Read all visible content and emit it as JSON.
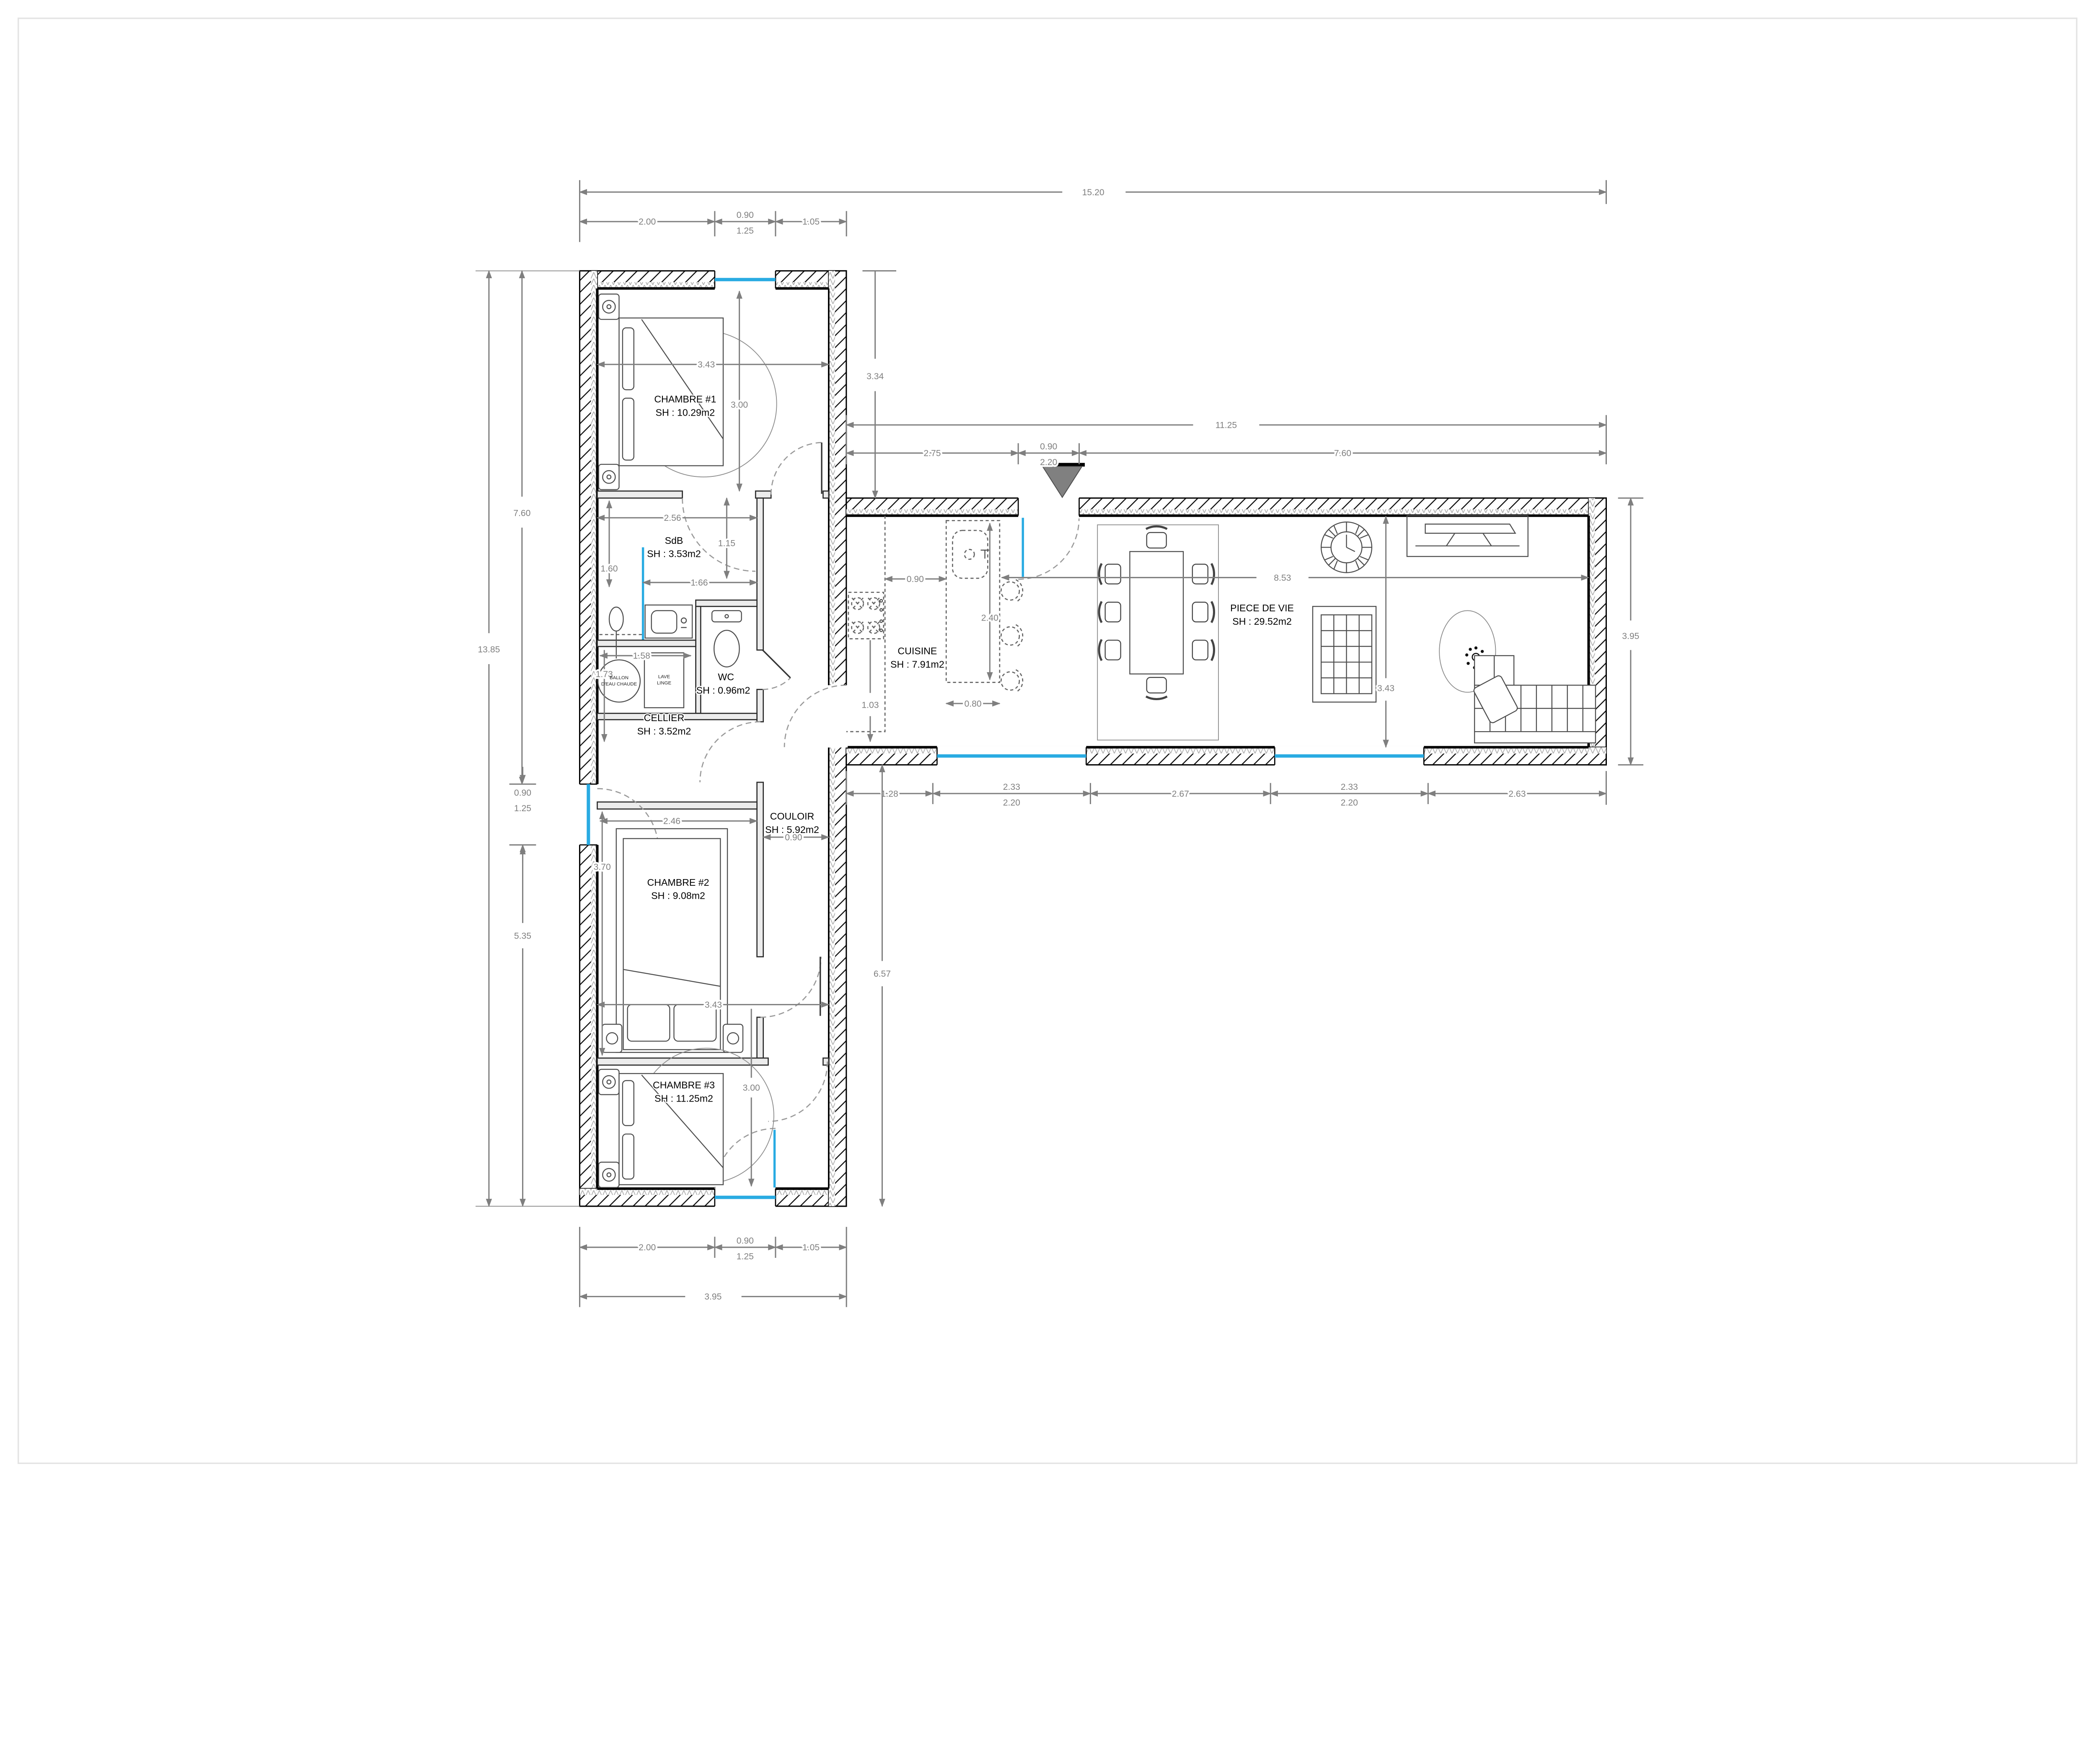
{
  "page": {
    "background": "#ffffff",
    "border_color": "#e3e3e3"
  },
  "colors": {
    "window": "#29abe2",
    "dimension": "#7f7f7f",
    "wall": "#000000",
    "partition_fill": "#ececec",
    "entrance_marker": "#808080"
  },
  "rooms": [
    {
      "id": "chambre1",
      "name": "CHAMBRE #1",
      "area": "SH : 10.29m2"
    },
    {
      "id": "sdb",
      "name": "SdB",
      "area": "SH : 3.53m2"
    },
    {
      "id": "wc",
      "name": "WC",
      "area": "SH : 0.96m2"
    },
    {
      "id": "cellier",
      "name": "CELLIER",
      "area": "SH : 3.52m2"
    },
    {
      "id": "couloir",
      "name": "COULOIR",
      "area": "SH : 5.92m2"
    },
    {
      "id": "chambre2",
      "name": "CHAMBRE #2",
      "area": "SH : 9.08m2"
    },
    {
      "id": "chambre3",
      "name": "CHAMBRE #3",
      "area": "SH : 11.25m2"
    },
    {
      "id": "cuisine",
      "name": "CUISINE",
      "area": "SH : 7.91m2"
    },
    {
      "id": "piece_de_vie",
      "name": "PIECE DE VIE",
      "area": "SH : 29.52m2"
    }
  ],
  "fixtures": {
    "ballon_l1": "BALLON",
    "ballon_l2": "D'EAU CHAUDE",
    "lave_l1": "LAVE",
    "lave_l2": "LINGE"
  },
  "dims": {
    "overall_width": "15.20",
    "top_a": "2.00",
    "top_b": "0.90",
    "top_b2": "1.25",
    "top_c": "1.05",
    "left_total": "13.85",
    "left_a": "7.60",
    "left_b": "0.90",
    "left_b2": "1.25",
    "left_c": "5.35",
    "bottom_a": "2.00",
    "bottom_b": "0.90",
    "bottom_b2": "1.25",
    "bottom_c": "1.05",
    "bottom_total": "3.95",
    "wing_width": "11.25",
    "wing_a": "2.75",
    "wing_b": "0.90",
    "wing_b2": "2.20",
    "wing_c": "7.60",
    "wing_height": "3.95",
    "top_offset": "3.34",
    "passage": "1.03",
    "lower_height": "6.57",
    "wing_bot_a": "1.28",
    "wing_bot_b": "2.33",
    "wing_bot_b2": "2.20",
    "wing_bot_c": "2.67",
    "wing_bot_d": "2.33",
    "wing_bot_d2": "2.20",
    "wing_bot_e": "2.63",
    "ch1_w": "3.43",
    "ch1_h": "3.00",
    "sdb_w": "2.56",
    "sdb_r": "1.15",
    "sdb_inner": "1.66",
    "sdb_l": "1.60",
    "cel_h": "1.73",
    "cel_w": "1.58",
    "ch2_w": "2.46",
    "ch2_h": "3.70",
    "corridor_w": "0.90",
    "ch3_w": "3.43",
    "ch3_h": "3.00",
    "kit_gap": "0.90",
    "island_l": "2.40",
    "island_w": "0.80",
    "living_w": "8.53",
    "living_h": "3.43"
  }
}
